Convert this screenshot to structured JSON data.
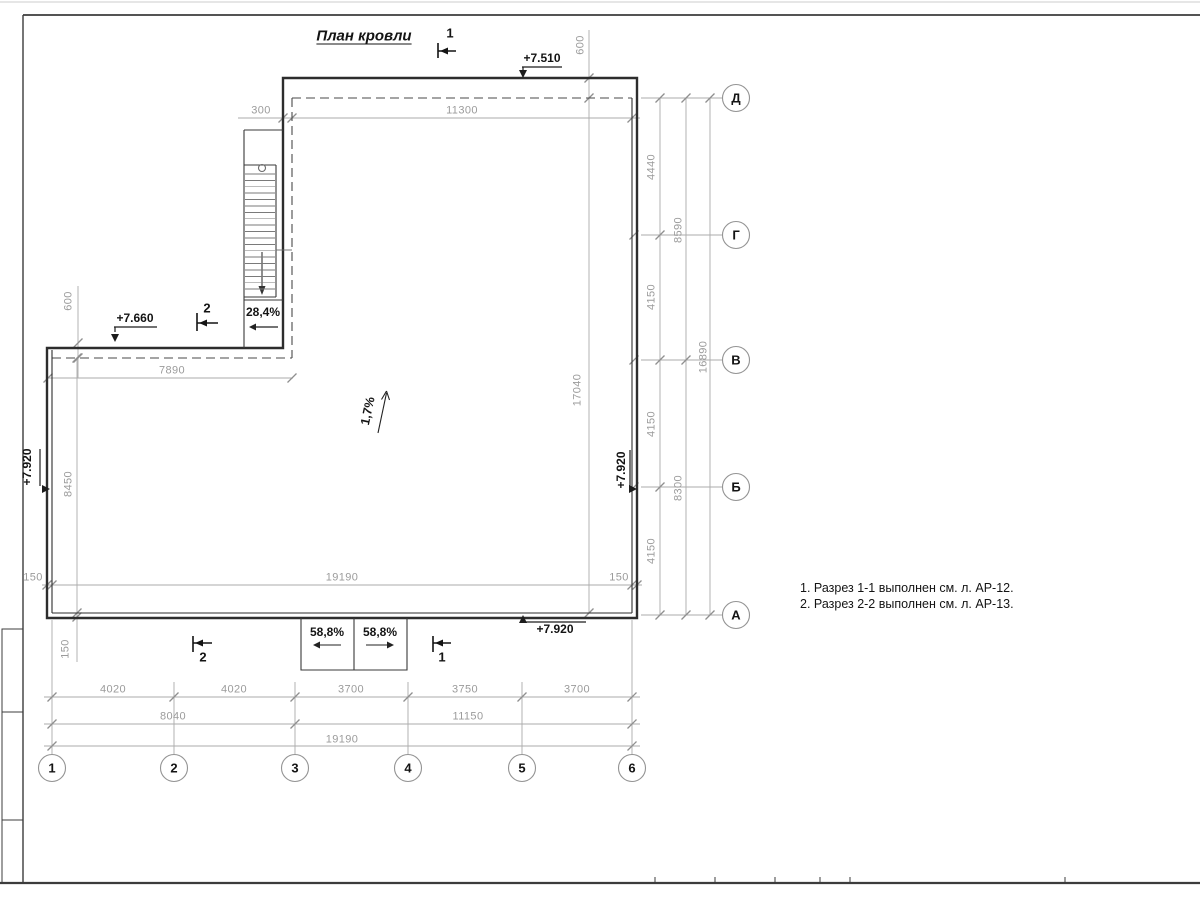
{
  "sheet": {
    "title": "План кровли"
  },
  "sections": {
    "cut1": "1",
    "cut2": "2"
  },
  "elevations": {
    "roof_high": "+7.510",
    "roof_ledge": "+7.660",
    "roof_main": "+7.920"
  },
  "slopes": {
    "main": "1,7%",
    "ladder": "28,4%",
    "scuppers": [
      "58,8%",
      "58,8%"
    ]
  },
  "axes": {
    "rows": [
      "Д",
      "Г",
      "В",
      "Б",
      "А"
    ],
    "cols": [
      "1",
      "2",
      "3",
      "4",
      "5",
      "6"
    ]
  },
  "dimensions": {
    "top": {
      "offset": "300",
      "span": "11300",
      "overhang": "600"
    },
    "right": {
      "segments": [
        "4440",
        "4150",
        "4150",
        "4150"
      ],
      "groups": [
        "8590",
        "8300"
      ],
      "total": "16890"
    },
    "left": {
      "overhang": "600",
      "span": "7890",
      "height": "8450",
      "wall_thickness": "150",
      "inner_width": "19190",
      "inner_height": "17040"
    },
    "bottom": {
      "segments": [
        "4020",
        "4020",
        "3700",
        "3750",
        "3700"
      ],
      "groups": [
        "8040",
        "11150"
      ],
      "total": "19190"
    }
  },
  "notes": [
    "1. Разрез 1-1 выполнен см. л. АР-12.",
    "2. Разрез 2-2 выполнен см. л. АР-13."
  ]
}
